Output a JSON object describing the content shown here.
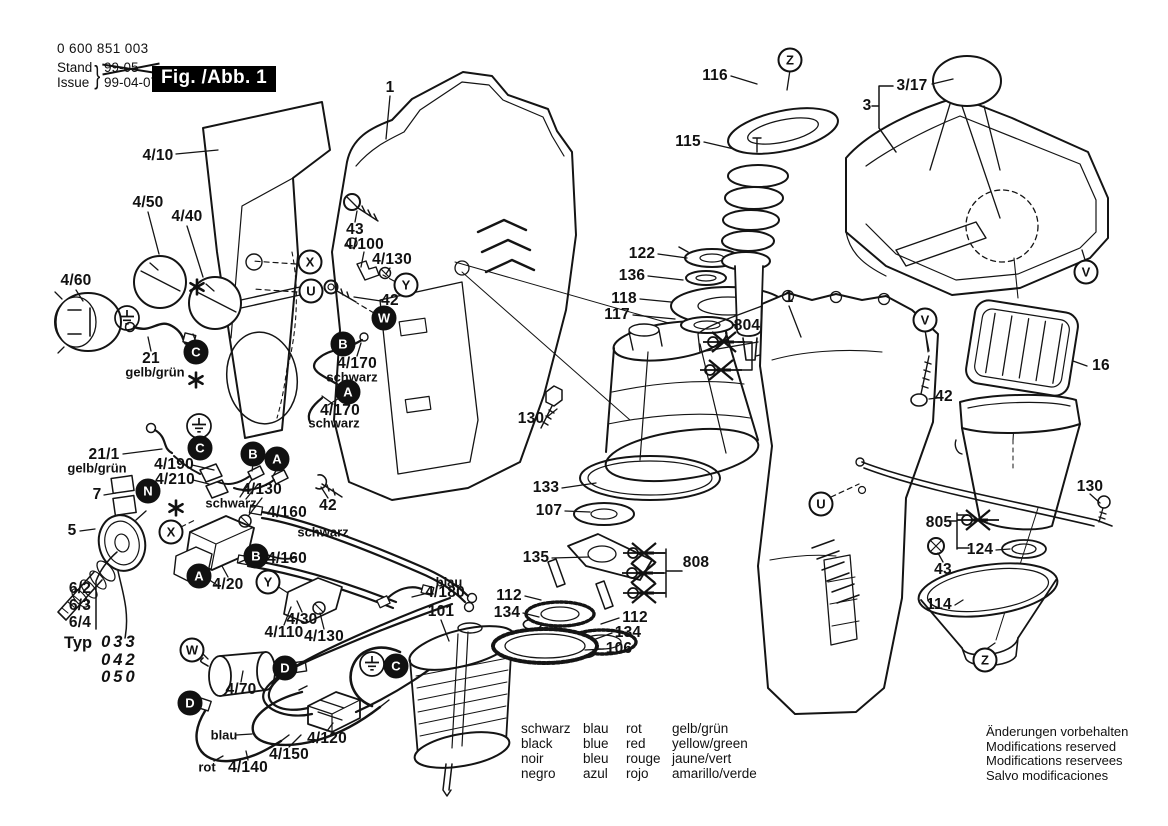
{
  "header": {
    "order_number": "0 600 851 003",
    "stand_label": "Stand",
    "issue_label": "Issue",
    "superseded_date": "99-05",
    "issue_date": "99-04-07",
    "figure_label": "Fig. /Abb. 1"
  },
  "typ": {
    "label": "Typ",
    "values": [
      "033",
      "042",
      "050"
    ]
  },
  "legend": {
    "columns": [
      [
        "schwarz",
        "black",
        "noir",
        "negro"
      ],
      [
        "blau",
        "blue",
        "bleu",
        "azul"
      ],
      [
        "rot",
        "red",
        "rouge",
        "rojo"
      ],
      [
        "gelb/grün",
        "yellow/green",
        "jaune/vert",
        "amarillo/verde"
      ]
    ]
  },
  "notices": [
    "Änderungen vorbehalten",
    "Modifications reserved",
    "Modifications reservees",
    "Salvo modificaciones"
  ],
  "labels": [
    {
      "text": "4/10",
      "x": 158,
      "y": 156,
      "k": "part"
    },
    {
      "text": "4/50",
      "x": 148,
      "y": 203,
      "k": "part"
    },
    {
      "text": "4/40",
      "x": 187,
      "y": 217,
      "k": "part"
    },
    {
      "text": "4/60",
      "x": 76,
      "y": 281,
      "k": "part"
    },
    {
      "text": "43",
      "x": 355,
      "y": 230,
      "k": "part"
    },
    {
      "text": "4/100",
      "x": 364,
      "y": 245,
      "k": "part"
    },
    {
      "text": "4/130",
      "x": 392,
      "y": 260,
      "k": "part"
    },
    {
      "text": "42",
      "x": 390,
      "y": 301,
      "k": "part"
    },
    {
      "text": "4/170",
      "x": 357,
      "y": 364,
      "k": "part"
    },
    {
      "text": "schwarz",
      "x": 352,
      "y": 377,
      "k": "color"
    },
    {
      "text": "4/170",
      "x": 340,
      "y": 411,
      "k": "part"
    },
    {
      "text": "schwarz",
      "x": 334,
      "y": 423,
      "k": "color"
    },
    {
      "text": "21",
      "x": 151,
      "y": 359,
      "k": "part"
    },
    {
      "text": "gelb/grün",
      "x": 155,
      "y": 372,
      "k": "color"
    },
    {
      "text": "21/1",
      "x": 104,
      "y": 455,
      "k": "part"
    },
    {
      "text": "gelb/grün",
      "x": 97,
      "y": 468,
      "k": "color"
    },
    {
      "text": "4/190",
      "x": 174,
      "y": 465,
      "k": "part"
    },
    {
      "text": "4/210",
      "x": 175,
      "y": 480,
      "k": "part"
    },
    {
      "text": "7",
      "x": 97,
      "y": 495,
      "k": "part"
    },
    {
      "text": "schwarz",
      "x": 231,
      "y": 503,
      "k": "color"
    },
    {
      "text": "4/130",
      "x": 262,
      "y": 490,
      "k": "part"
    },
    {
      "text": "5",
      "x": 72,
      "y": 531,
      "k": "part"
    },
    {
      "text": "42",
      "x": 328,
      "y": 506,
      "k": "part"
    },
    {
      "text": "4/160",
      "x": 287,
      "y": 513,
      "k": "part"
    },
    {
      "text": "schwarz",
      "x": 323,
      "y": 532,
      "k": "color"
    },
    {
      "text": "4/160",
      "x": 287,
      "y": 559,
      "k": "part"
    },
    {
      "text": "4/20",
      "x": 228,
      "y": 585,
      "k": "part"
    },
    {
      "text": "6/2",
      "x": 80,
      "y": 589,
      "k": "part"
    },
    {
      "text": "6/3",
      "x": 80,
      "y": 606,
      "k": "part"
    },
    {
      "text": "6/4",
      "x": 80,
      "y": 623,
      "k": "part"
    },
    {
      "text": "blau",
      "x": 449,
      "y": 582,
      "k": "color"
    },
    {
      "text": "4/180",
      "x": 445,
      "y": 593,
      "k": "part"
    },
    {
      "text": "4/30",
      "x": 302,
      "y": 620,
      "k": "part"
    },
    {
      "text": "4/110",
      "x": 284,
      "y": 633,
      "k": "part"
    },
    {
      "text": "4/130",
      "x": 324,
      "y": 637,
      "k": "part"
    },
    {
      "text": "101",
      "x": 441,
      "y": 612,
      "k": "part"
    },
    {
      "text": "4/70",
      "x": 241,
      "y": 690,
      "k": "part"
    },
    {
      "text": "blau",
      "x": 224,
      "y": 735,
      "k": "color"
    },
    {
      "text": "rot",
      "x": 207,
      "y": 767,
      "k": "color"
    },
    {
      "text": "4/140",
      "x": 248,
      "y": 768,
      "k": "part"
    },
    {
      "text": "4/150",
      "x": 289,
      "y": 755,
      "k": "part"
    },
    {
      "text": "4/120",
      "x": 327,
      "y": 739,
      "k": "part"
    },
    {
      "text": "1",
      "x": 390,
      "y": 88,
      "k": "part"
    },
    {
      "text": "116",
      "x": 715,
      "y": 76,
      "k": "part"
    },
    {
      "text": "115",
      "x": 688,
      "y": 142,
      "k": "part"
    },
    {
      "text": "122",
      "x": 642,
      "y": 254,
      "k": "part"
    },
    {
      "text": "136",
      "x": 632,
      "y": 276,
      "k": "part"
    },
    {
      "text": "118",
      "x": 624,
      "y": 299,
      "k": "part"
    },
    {
      "text": "117",
      "x": 617,
      "y": 315,
      "k": "part"
    },
    {
      "text": "804",
      "x": 747,
      "y": 326,
      "k": "part"
    },
    {
      "text": "1",
      "x": 789,
      "y": 298,
      "k": "part"
    },
    {
      "text": "130",
      "x": 531,
      "y": 419,
      "k": "part"
    },
    {
      "text": "133",
      "x": 546,
      "y": 488,
      "k": "part"
    },
    {
      "text": "107",
      "x": 549,
      "y": 511,
      "k": "part"
    },
    {
      "text": "135",
      "x": 536,
      "y": 558,
      "k": "part"
    },
    {
      "text": "808",
      "x": 696,
      "y": 563,
      "k": "part"
    },
    {
      "text": "112",
      "x": 509,
      "y": 596,
      "k": "part"
    },
    {
      "text": "134",
      "x": 507,
      "y": 613,
      "k": "part"
    },
    {
      "text": "112",
      "x": 635,
      "y": 618,
      "k": "part"
    },
    {
      "text": "134",
      "x": 628,
      "y": 633,
      "k": "part"
    },
    {
      "text": "106",
      "x": 619,
      "y": 649,
      "k": "part"
    },
    {
      "text": "3/17",
      "x": 912,
      "y": 86,
      "k": "part"
    },
    {
      "text": "3",
      "x": 867,
      "y": 106,
      "k": "part"
    },
    {
      "text": "42",
      "x": 944,
      "y": 397,
      "k": "part"
    },
    {
      "text": "16",
      "x": 1101,
      "y": 366,
      "k": "part"
    },
    {
      "text": "130",
      "x": 1090,
      "y": 487,
      "k": "part"
    },
    {
      "text": "805",
      "x": 939,
      "y": 523,
      "k": "part"
    },
    {
      "text": "124",
      "x": 980,
      "y": 550,
      "k": "part"
    },
    {
      "text": "43",
      "x": 943,
      "y": 570,
      "k": "part"
    },
    {
      "text": "114",
      "x": 939,
      "y": 605,
      "k": "part"
    }
  ],
  "markers": [
    {
      "letter": "X",
      "x": 310,
      "y": 262,
      "filled": false
    },
    {
      "letter": "U",
      "x": 311,
      "y": 291,
      "filled": false
    },
    {
      "letter": "Y",
      "x": 406,
      "y": 285,
      "filled": false
    },
    {
      "letter": "W",
      "x": 384,
      "y": 318,
      "filled": true
    },
    {
      "letter": "B",
      "x": 343,
      "y": 344,
      "filled": true
    },
    {
      "letter": "A",
      "x": 348,
      "y": 392,
      "filled": true
    },
    {
      "letter": "C",
      "x": 196,
      "y": 352,
      "filled": true
    },
    {
      "letter": "C",
      "x": 200,
      "y": 448,
      "filled": true
    },
    {
      "letter": "N",
      "x": 148,
      "y": 491,
      "filled": true
    },
    {
      "letter": "B",
      "x": 253,
      "y": 454,
      "filled": true
    },
    {
      "letter": "A",
      "x": 277,
      "y": 459,
      "filled": true
    },
    {
      "letter": "X",
      "x": 171,
      "y": 532,
      "filled": false
    },
    {
      "letter": "B",
      "x": 256,
      "y": 556,
      "filled": true
    },
    {
      "letter": "A",
      "x": 199,
      "y": 576,
      "filled": true
    },
    {
      "letter": "Y",
      "x": 268,
      "y": 582,
      "filled": false
    },
    {
      "letter": "W",
      "x": 192,
      "y": 650,
      "filled": false
    },
    {
      "letter": "D",
      "x": 285,
      "y": 668,
      "filled": true
    },
    {
      "letter": "D",
      "x": 190,
      "y": 703,
      "filled": true
    },
    {
      "letter": "C",
      "x": 396,
      "y": 666,
      "filled": true
    },
    {
      "letter": "Z",
      "x": 790,
      "y": 60,
      "filled": false
    },
    {
      "letter": "V",
      "x": 1086,
      "y": 272,
      "filled": false
    },
    {
      "letter": "V",
      "x": 925,
      "y": 320,
      "filled": false
    },
    {
      "letter": "U",
      "x": 821,
      "y": 504,
      "filled": false
    },
    {
      "letter": "Z",
      "x": 985,
      "y": 660,
      "filled": false
    }
  ],
  "symbols": [
    {
      "type": "ground",
      "x": 127,
      "y": 318
    },
    {
      "type": "ground",
      "x": 199,
      "y": 426
    },
    {
      "type": "ground",
      "x": 372,
      "y": 664
    },
    {
      "type": "asterisk",
      "x": 197,
      "y": 287
    },
    {
      "type": "asterisk",
      "x": 196,
      "y": 380
    },
    {
      "type": "asterisk",
      "x": 176,
      "y": 508
    },
    {
      "type": "crossed",
      "x": 724,
      "y": 342
    },
    {
      "type": "crossed",
      "x": 721,
      "y": 370
    },
    {
      "type": "crossed",
      "x": 644,
      "y": 553
    },
    {
      "type": "crossed",
      "x": 643,
      "y": 573
    },
    {
      "type": "crossed",
      "x": 644,
      "y": 593
    },
    {
      "type": "crossed",
      "x": 978,
      "y": 520
    }
  ]
}
